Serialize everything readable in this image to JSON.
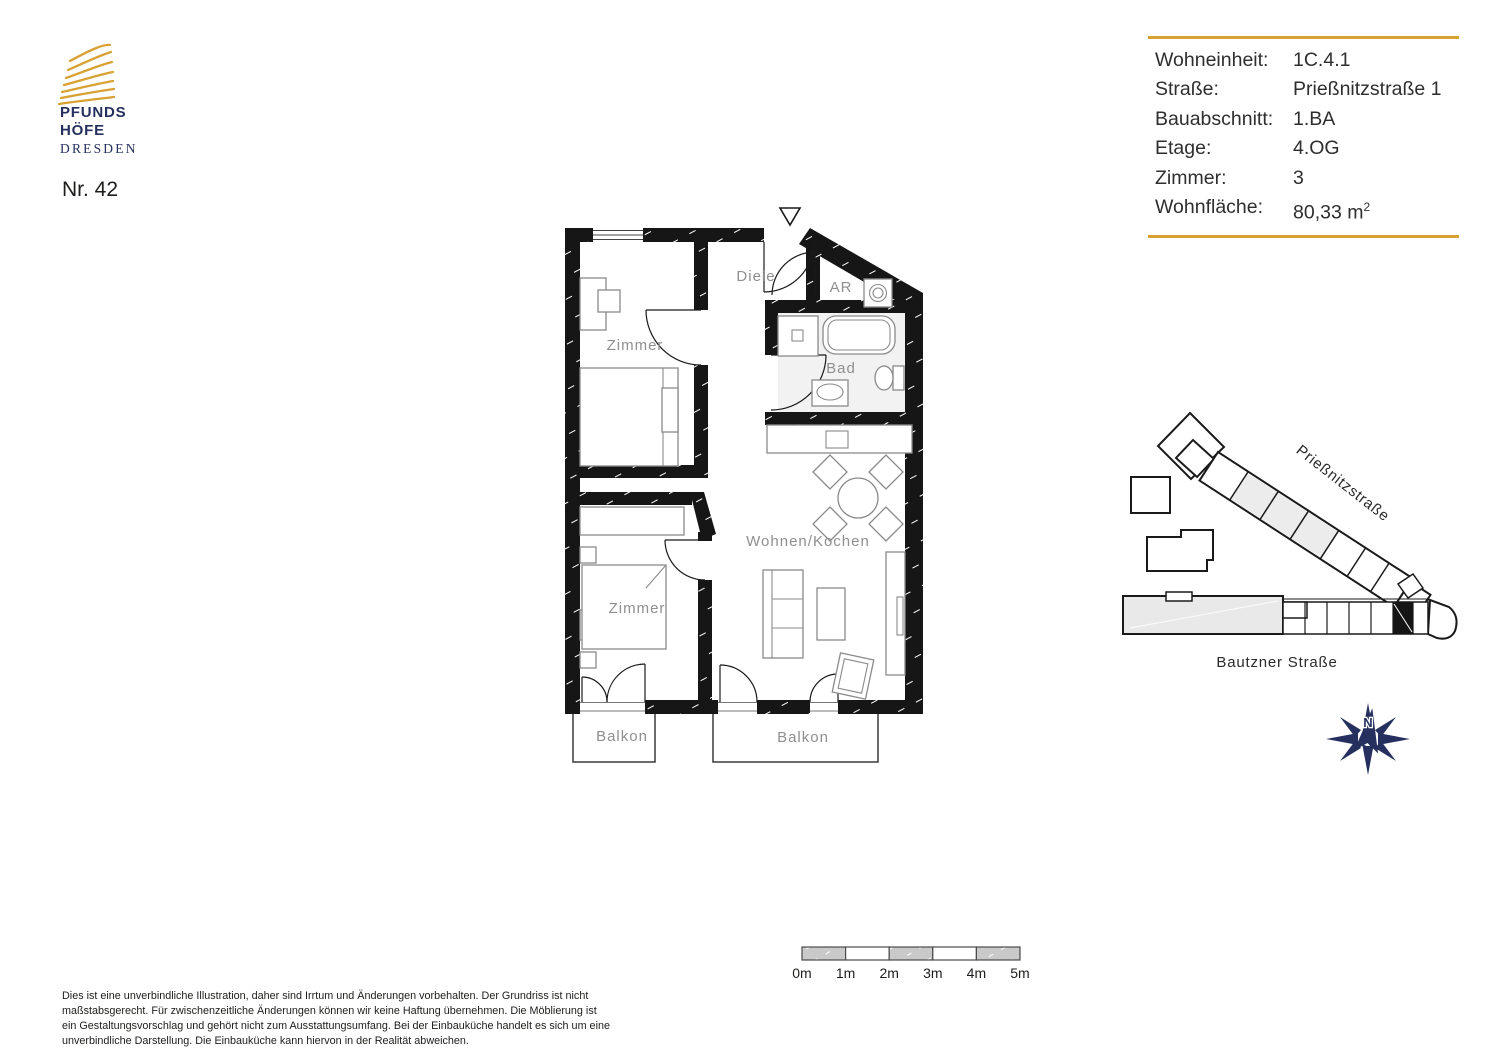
{
  "branding": {
    "logo_line1": "PFUNDS",
    "logo_line2": "HÖFE",
    "logo_line3": "DRESDEN",
    "unit_number": "Nr. 42"
  },
  "colors": {
    "accent_gold": "#D8A233",
    "brand_navy": "#25305F"
  },
  "info_table": {
    "rows": [
      {
        "label": "Wohneinheit:",
        "value": "1C.4.1"
      },
      {
        "label": "Straße:",
        "value": "Prießnitzstraße 1"
      },
      {
        "label": "Bauabschnitt:",
        "value": "1.BA"
      },
      {
        "label": "Etage:",
        "value": "4.OG"
      },
      {
        "label": "Zimmer:",
        "value": "3"
      },
      {
        "label": "Wohnfläche:",
        "value": "80,33 m",
        "value_sup": "2"
      }
    ]
  },
  "floor_plan": {
    "labels": {
      "diele": "Diele",
      "ar": "AR",
      "zimmer_top": "Zimmer",
      "bad": "Bad",
      "wohnen_kochen": "Wohnen/Kochen",
      "zimmer_bottom": "Zimmer",
      "balkon_left": "Balkon",
      "balkon_right": "Balkon"
    }
  },
  "site_plan": {
    "street_diagonal": "Prießnitzstraße",
    "street_bottom": "Bautzner Straße",
    "compass_north": "N"
  },
  "scale_bar": {
    "labels": [
      "0m",
      "1m",
      "2m",
      "3m",
      "4m",
      "5m"
    ]
  },
  "disclaimer": {
    "lines": [
      "Dies ist eine unverbindliche Illustration, daher sind Irrtum und Änderungen vorbehalten. Der Grundriss ist nicht",
      "maßstabsgerecht. Für zwischenzeitliche Änderungen können wir keine Haftung übernehmen. Die Möblierung ist",
      "ein Gestaltungsvorschlag und gehört nicht zum Ausstattungsumfang. Bei der Einbauküche handelt es sich um eine",
      "unverbindliche Darstellung. Die Einbauküche kann hiervon in der Realität abweichen."
    ]
  }
}
